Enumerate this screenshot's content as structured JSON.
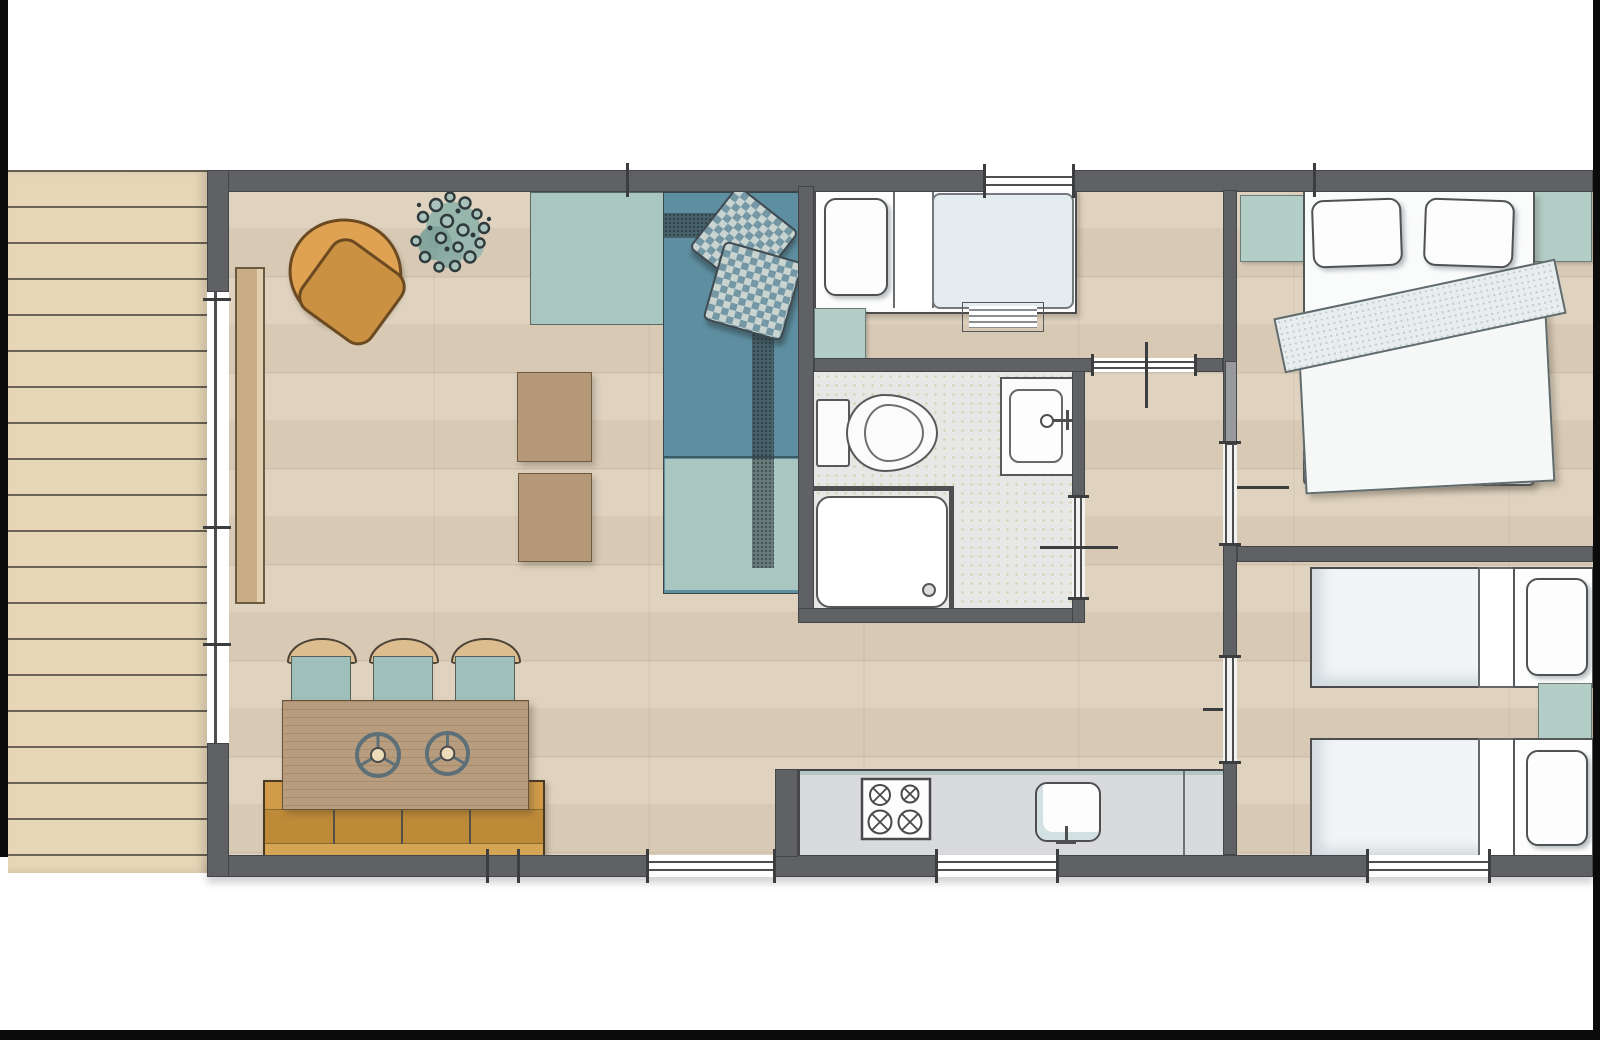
{
  "title": "Holiday lodge floor plan",
  "palette": {
    "background": "#ffffff",
    "frame_black": "#0b0b0b",
    "wall_gray": "#5f6164",
    "wood_floor": "#ddd0bc",
    "deck_wood": "#e6d6b6",
    "bathroom_floor": "#e7e7e5",
    "sofa_teal_dark": "#5e8fa1",
    "sofa_teal_light": "#a9c6c0",
    "cabinet_teal": "#b3cec6",
    "armchair_orange": "#dfa252",
    "bench_orange": "#c8923d",
    "table_wood": "#b79c7e",
    "ottoman_tan": "#b59878",
    "fixture_white": "#fbfbfb",
    "outline_dark": "#4c4e50"
  },
  "rooms": {
    "terrace": "Terrace deck",
    "living": "Living area",
    "kitchen": "Kitchen",
    "single_bedroom": "Single bedroom",
    "bathroom": "Bathroom",
    "hallway": "Hallway",
    "master_bedroom": "Double bedroom",
    "twin_bedroom": "Twin bedroom"
  },
  "furniture": {
    "living": [
      "armchair",
      "potted-plant",
      "corner-sofa",
      "checkered-cushions",
      "ottoman",
      "ottoman",
      "dining-table",
      "dining-chair",
      "dining-chair",
      "dining-chair",
      "bench"
    ],
    "kitchen": [
      "kitchen-counter",
      "stove-4-burners",
      "kitchen-sink"
    ],
    "single_bedroom": [
      "single-bed",
      "pillow",
      "luggage-rack",
      "nightstand"
    ],
    "bathroom": [
      "toilet",
      "washbasin",
      "shower"
    ],
    "master_bedroom": [
      "double-bed",
      "pillow",
      "pillow",
      "duvet",
      "nightstand",
      "nightstand"
    ],
    "twin_bedroom": [
      "twin-bed",
      "twin-bed",
      "pillow",
      "pillow",
      "nightstand"
    ]
  },
  "openings": {
    "windows": [
      "top-wall-window",
      "bottom-wall-window-living",
      "bottom-wall-window-kitchen",
      "bottom-wall-window-twin-bedroom"
    ],
    "doors": [
      "terrace-sliding-door",
      "single-bedroom-sliding-door",
      "bathroom-sliding-door",
      "master-bedroom-sliding-door",
      "twin-bedroom-sliding-door"
    ]
  }
}
